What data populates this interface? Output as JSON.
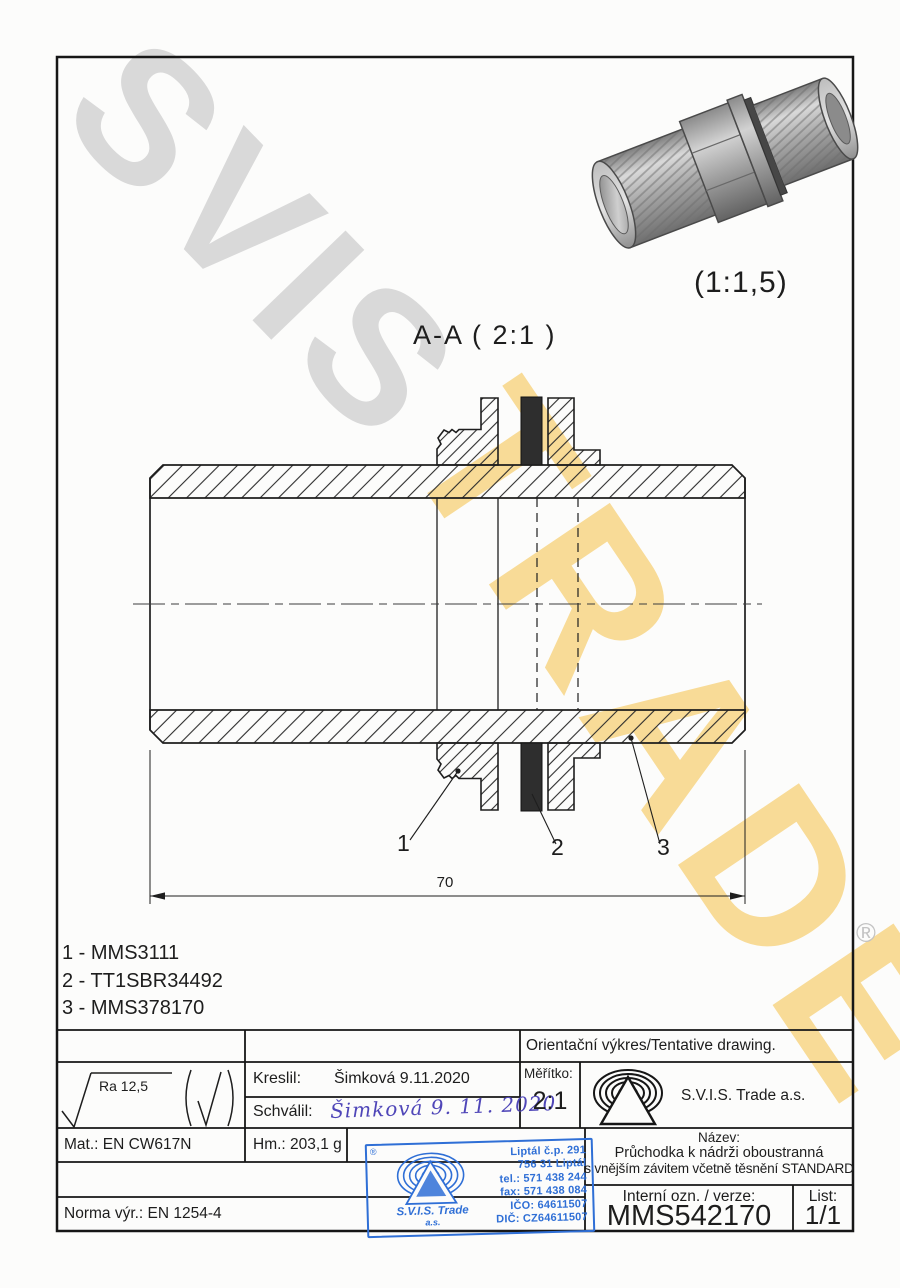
{
  "watermark": {
    "text_gray": "SVIS",
    "text_yellow": "TRADE",
    "registered": "®",
    "gray_color": "#d9d9d9",
    "yellow_color": "#f8db97"
  },
  "render_3d": {
    "scale_label": "(1:1,5)"
  },
  "section_view": {
    "title": "A-A ( 2:1 )",
    "dimension_70": "70",
    "callout_1": "1",
    "callout_2": "2",
    "callout_3": "3"
  },
  "parts_list": {
    "item_1": "1 - MMS3111",
    "item_2": "2 - TT1SBR34492",
    "item_3": "3 - MMS378170"
  },
  "title_block": {
    "tentative": "Orientační výkres/Tentative drawing.",
    "ra_label": "Ra 12,5",
    "kreslil_label": "Kreslil:",
    "kreslil_value": "Šimková 9.11.2020",
    "schvalil_label": "Schválil:",
    "schvalil_value": "Šimková 9. 11. 2020",
    "meritko_label": "Měřítko:",
    "meritko_value": "2:1",
    "company": "S.V.I.S. Trade a.s.",
    "mat": "Mat.: EN CW617N",
    "hm": "Hm.: 203,1 g",
    "nazev_label": "Název:",
    "nazev_line1": "Průchodka k nádrži oboustranná",
    "nazev_line2": "s vnějším závitem včetně těsnění STANDARD",
    "interni_label": "Interní ozn. / verze:",
    "interni_value": "MMS542170",
    "list_label": "List:",
    "list_value": "1/1",
    "norma": "Norma výr.: EN 1254-4",
    "signature_color": "#4f46b8"
  },
  "stamp": {
    "registered": "®",
    "company_line1": "S.V.I.S. Trade",
    "company_line2": "a.s.",
    "address_1": "Liptál č.p. 291",
    "address_2": "756 31 Liptál",
    "address_3": "tel.: 571 438 244",
    "address_4": "fax: 571 438 084",
    "address_5": "IČO: 64611507",
    "address_6": "DIČ: CZ64611507",
    "blue_color": "#2f6fd6"
  }
}
